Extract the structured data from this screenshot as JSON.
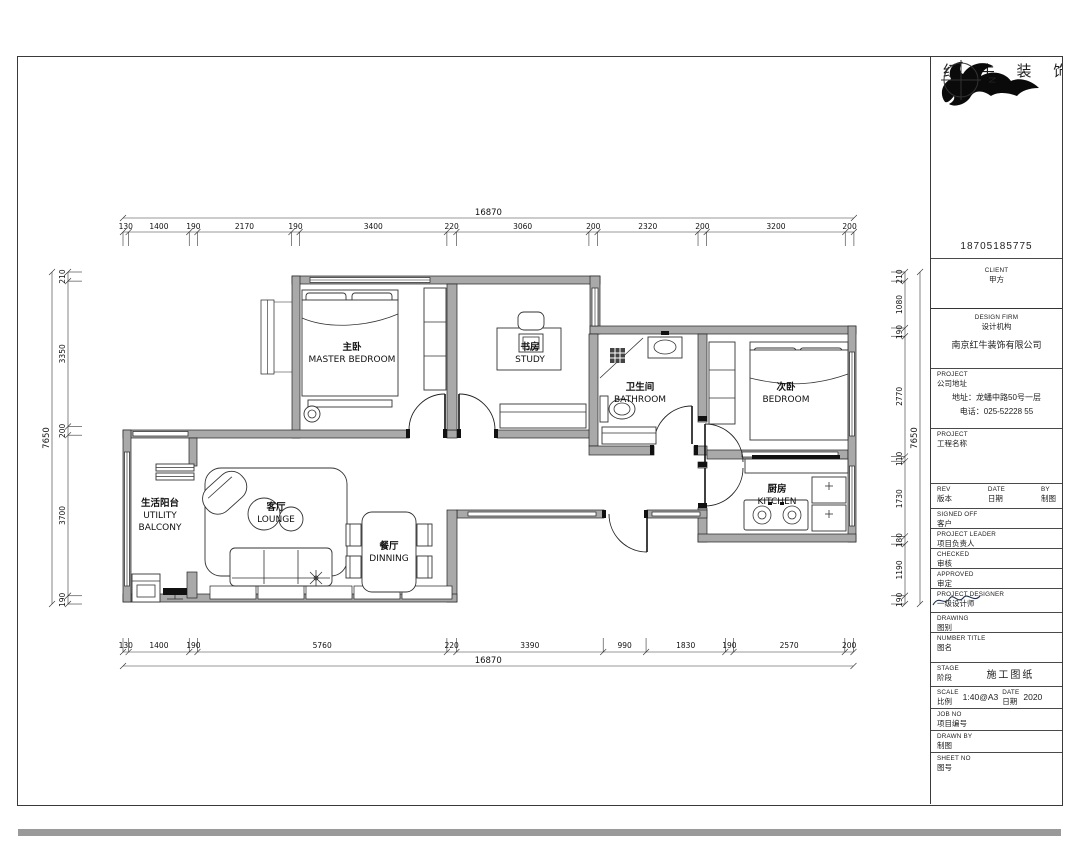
{
  "brand": {
    "name": "红 牛 装 饰",
    "phone": "18705185775",
    "compass_n": "N"
  },
  "titleblock": {
    "client_en": "CLIENT",
    "client_cn": "甲方",
    "firm_en": "DESIGN FIRM",
    "firm_cn": "设计机构",
    "firm_name": "南京红牛装饰有限公司",
    "addr_en": "PROJECT",
    "addr_cn": "公司地址",
    "addr_line1": "地址：龙蟠中路50号一层",
    "addr_line2": "电话：025-52228 55",
    "proj_en": "PROJECT",
    "proj_cn": "工程名称",
    "rev_en": "REV",
    "rev_cn": "版本",
    "date_en": "DATE",
    "date_cn": "日期",
    "by_en": "BY",
    "by_cn": "制图",
    "signed_en": "SIGNED OFF",
    "signed_cn": "客户",
    "leader_en": "PROJECT LEADER",
    "leader_cn": "项目负责人",
    "checked_en": "CHECKED",
    "checked_cn": "审核",
    "approved_en": "APPROVED",
    "approved_cn": "审定",
    "designer_en": "PROJECT DESIGNER",
    "designer_cn": "一级设计师",
    "drawing_en": "DRAWING",
    "drawing_cn": "图别",
    "numtitle_en": "NUMBER TITLE",
    "numtitle_cn": "图名",
    "stage_en": "STAGE",
    "stage_cn": "阶段",
    "stage_value": "施工图纸",
    "scale_en": "SCALE",
    "scale_cn": "比例",
    "scale_value": "1:40@A3",
    "scale_date_en": "DATE",
    "scale_date_cn": "日期",
    "scale_date_value": "2020",
    "job_en": "JOB NO",
    "job_cn": "项目编号",
    "drawn_en": "DRAWN BY",
    "drawn_cn": "制图",
    "sheet_en": "SHEET NO",
    "sheet_cn": "图号"
  },
  "rooms": {
    "master": {
      "cn": "主卧",
      "en": "MASTER BEDROOM"
    },
    "study": {
      "cn": "书房",
      "en": "STUDY"
    },
    "bathroom": {
      "cn": "卫生间",
      "en": "BATHROOM"
    },
    "bedroom": {
      "cn": "次卧",
      "en": "BEDROOM"
    },
    "balcony": {
      "cn": "生活阳台",
      "en1": "UTILITY",
      "en2": "BALCONY"
    },
    "lounge": {
      "cn": "客厅",
      "en": "LOUNGE"
    },
    "dining": {
      "cn": "餐厅",
      "en": "DINNING"
    },
    "kitchen": {
      "cn": "厨房",
      "en": "KITCHEN"
    }
  },
  "dimensions": {
    "top": {
      "total": "16870",
      "segments": [
        "130",
        "1400",
        "190",
        "2170",
        "190",
        "3400",
        "220",
        "3060",
        "200",
        "2320",
        "200",
        "3200",
        "200"
      ]
    },
    "bottom": {
      "total": "16870",
      "segments": [
        "130",
        "1400",
        "190",
        "5760",
        "220",
        "3390",
        "990",
        "1830",
        "190",
        "2570",
        "200"
      ]
    },
    "left": {
      "total": "7650",
      "segments": [
        "210",
        "3350",
        "200",
        "3700",
        "190"
      ]
    },
    "right": {
      "total": "7650",
      "segments": [
        "210",
        "1080",
        "190",
        "2770",
        "110",
        "1730",
        "180",
        "1190",
        "190"
      ]
    }
  }
}
